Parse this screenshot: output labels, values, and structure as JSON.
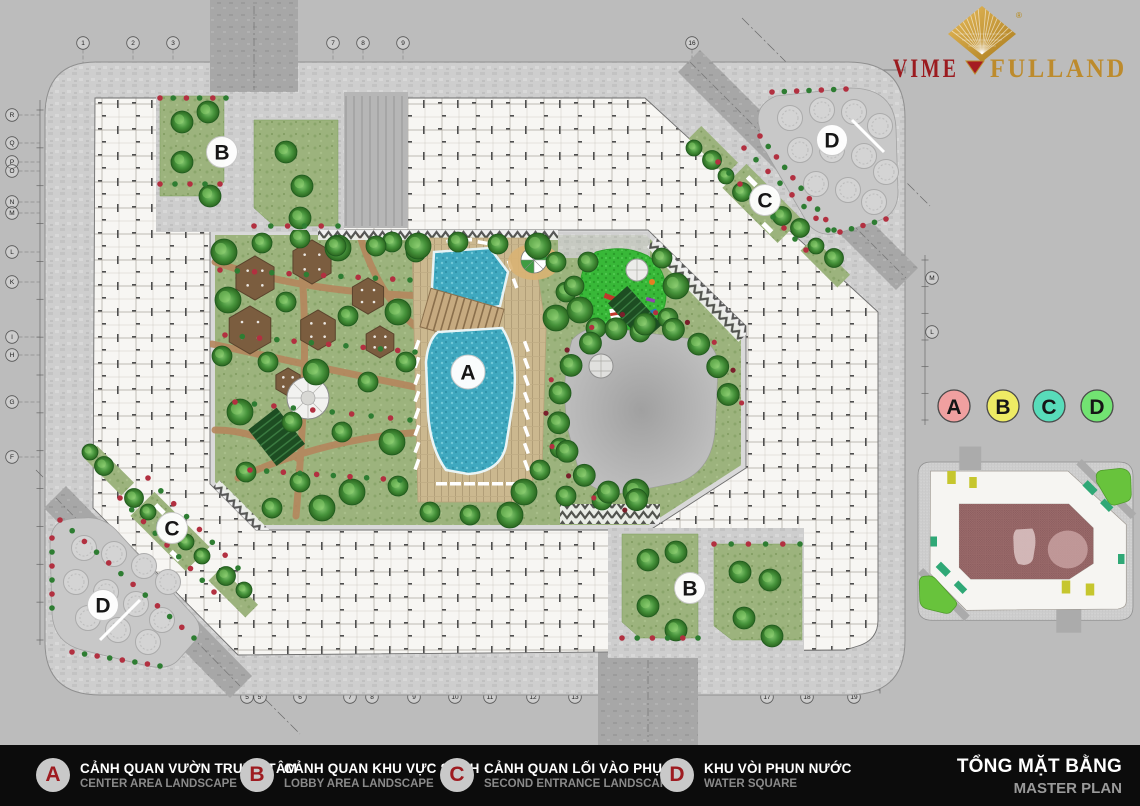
{
  "logo": {
    "brand_left": "VIME",
    "brand_right": "FULLAND",
    "registered": "®"
  },
  "legend_bar": {
    "items": [
      {
        "letter": "A",
        "vi": "CẢNH QUAN VƯỜN TRUNG TÂM",
        "en": "CENTER AREA LANDSCAPE"
      },
      {
        "letter": "B",
        "vi": "CẢNH QUAN KHU VỰC SẢNH",
        "en": "LOBBY AREA LANDSCAPE"
      },
      {
        "letter": "C",
        "vi": "CẢNH QUAN LỐI VÀO PHỤ",
        "en": "SECOND ENTRANCE LANDSCAPE"
      },
      {
        "letter": "D",
        "vi": "KHU VÒI PHUN NƯỚC",
        "en": "WATER SQUARE"
      }
    ],
    "title_vi": "TỔNG MẶT BẰNG",
    "title_en": "MASTER PLAN"
  },
  "area_key": {
    "badges": [
      {
        "letter": "A",
        "color": "#f0a0a0"
      },
      {
        "letter": "B",
        "color": "#eeeb64"
      },
      {
        "letter": "C",
        "color": "#58dcba"
      },
      {
        "letter": "D",
        "color": "#72e372"
      }
    ]
  },
  "plan": {
    "markers": [
      {
        "letter": "A",
        "x": 468,
        "y": 372
      },
      {
        "letter": "B",
        "x": 222,
        "y": 152
      },
      {
        "letter": "B",
        "x": 690,
        "y": 588
      },
      {
        "letter": "C",
        "x": 765,
        "y": 200
      },
      {
        "letter": "C",
        "x": 172,
        "y": 528
      },
      {
        "letter": "D",
        "x": 832,
        "y": 140
      },
      {
        "letter": "D",
        "x": 103,
        "y": 605
      }
    ]
  },
  "grid": {
    "top": [
      [
        "1",
        83
      ],
      [
        "2",
        133
      ],
      [
        "3",
        173
      ],
      [
        "7",
        333
      ],
      [
        "8",
        363
      ],
      [
        "9",
        403
      ],
      [
        "16",
        692
      ]
    ],
    "bottom": [
      [
        "5",
        247
      ],
      [
        "5'",
        260
      ],
      [
        "6",
        300
      ],
      [
        "7",
        350
      ],
      [
        "8",
        372
      ],
      [
        "9",
        414
      ],
      [
        "10",
        455
      ],
      [
        "11",
        490
      ],
      [
        "12",
        533
      ],
      [
        "13",
        575
      ],
      [
        "14",
        606
      ],
      [
        "17",
        767
      ],
      [
        "18",
        807
      ],
      [
        "19",
        854
      ]
    ],
    "left": [
      [
        "R",
        115
      ],
      [
        "Q",
        143
      ],
      [
        "P",
        162
      ],
      [
        "O",
        171
      ],
      [
        "N",
        202
      ],
      [
        "M",
        213
      ],
      [
        "L",
        252
      ],
      [
        "K",
        282
      ],
      [
        "I",
        337
      ],
      [
        "H",
        355
      ],
      [
        "G",
        402
      ],
      [
        "F",
        457
      ]
    ],
    "right": [
      [
        "M",
        278
      ],
      [
        "L",
        332
      ]
    ]
  },
  "colors": {
    "background": "#bcbcbc",
    "paving": "#cdcdcd",
    "road": "#a7a7a7",
    "building": "#f7f6f3",
    "pool": "#43aec6",
    "lawn": "#9ab37c",
    "playground": "#38b838",
    "plaza": "#b0b0b0",
    "flower_red": "#b23040",
    "tree_green": "#3f8f39",
    "legend_bar_bg": "#0c0c0c",
    "legend_circle": "#c9c9c9",
    "legend_letter": "#9e1b20",
    "logo_red": "#9b1b1f",
    "logo_gold": "#bd8b2d",
    "keyplan_center": "#9a6a6a",
    "keyplan_green": "#68c33c",
    "keyplan_teal": "#2fa876",
    "keyplan_yellow": "#c6c62e"
  }
}
